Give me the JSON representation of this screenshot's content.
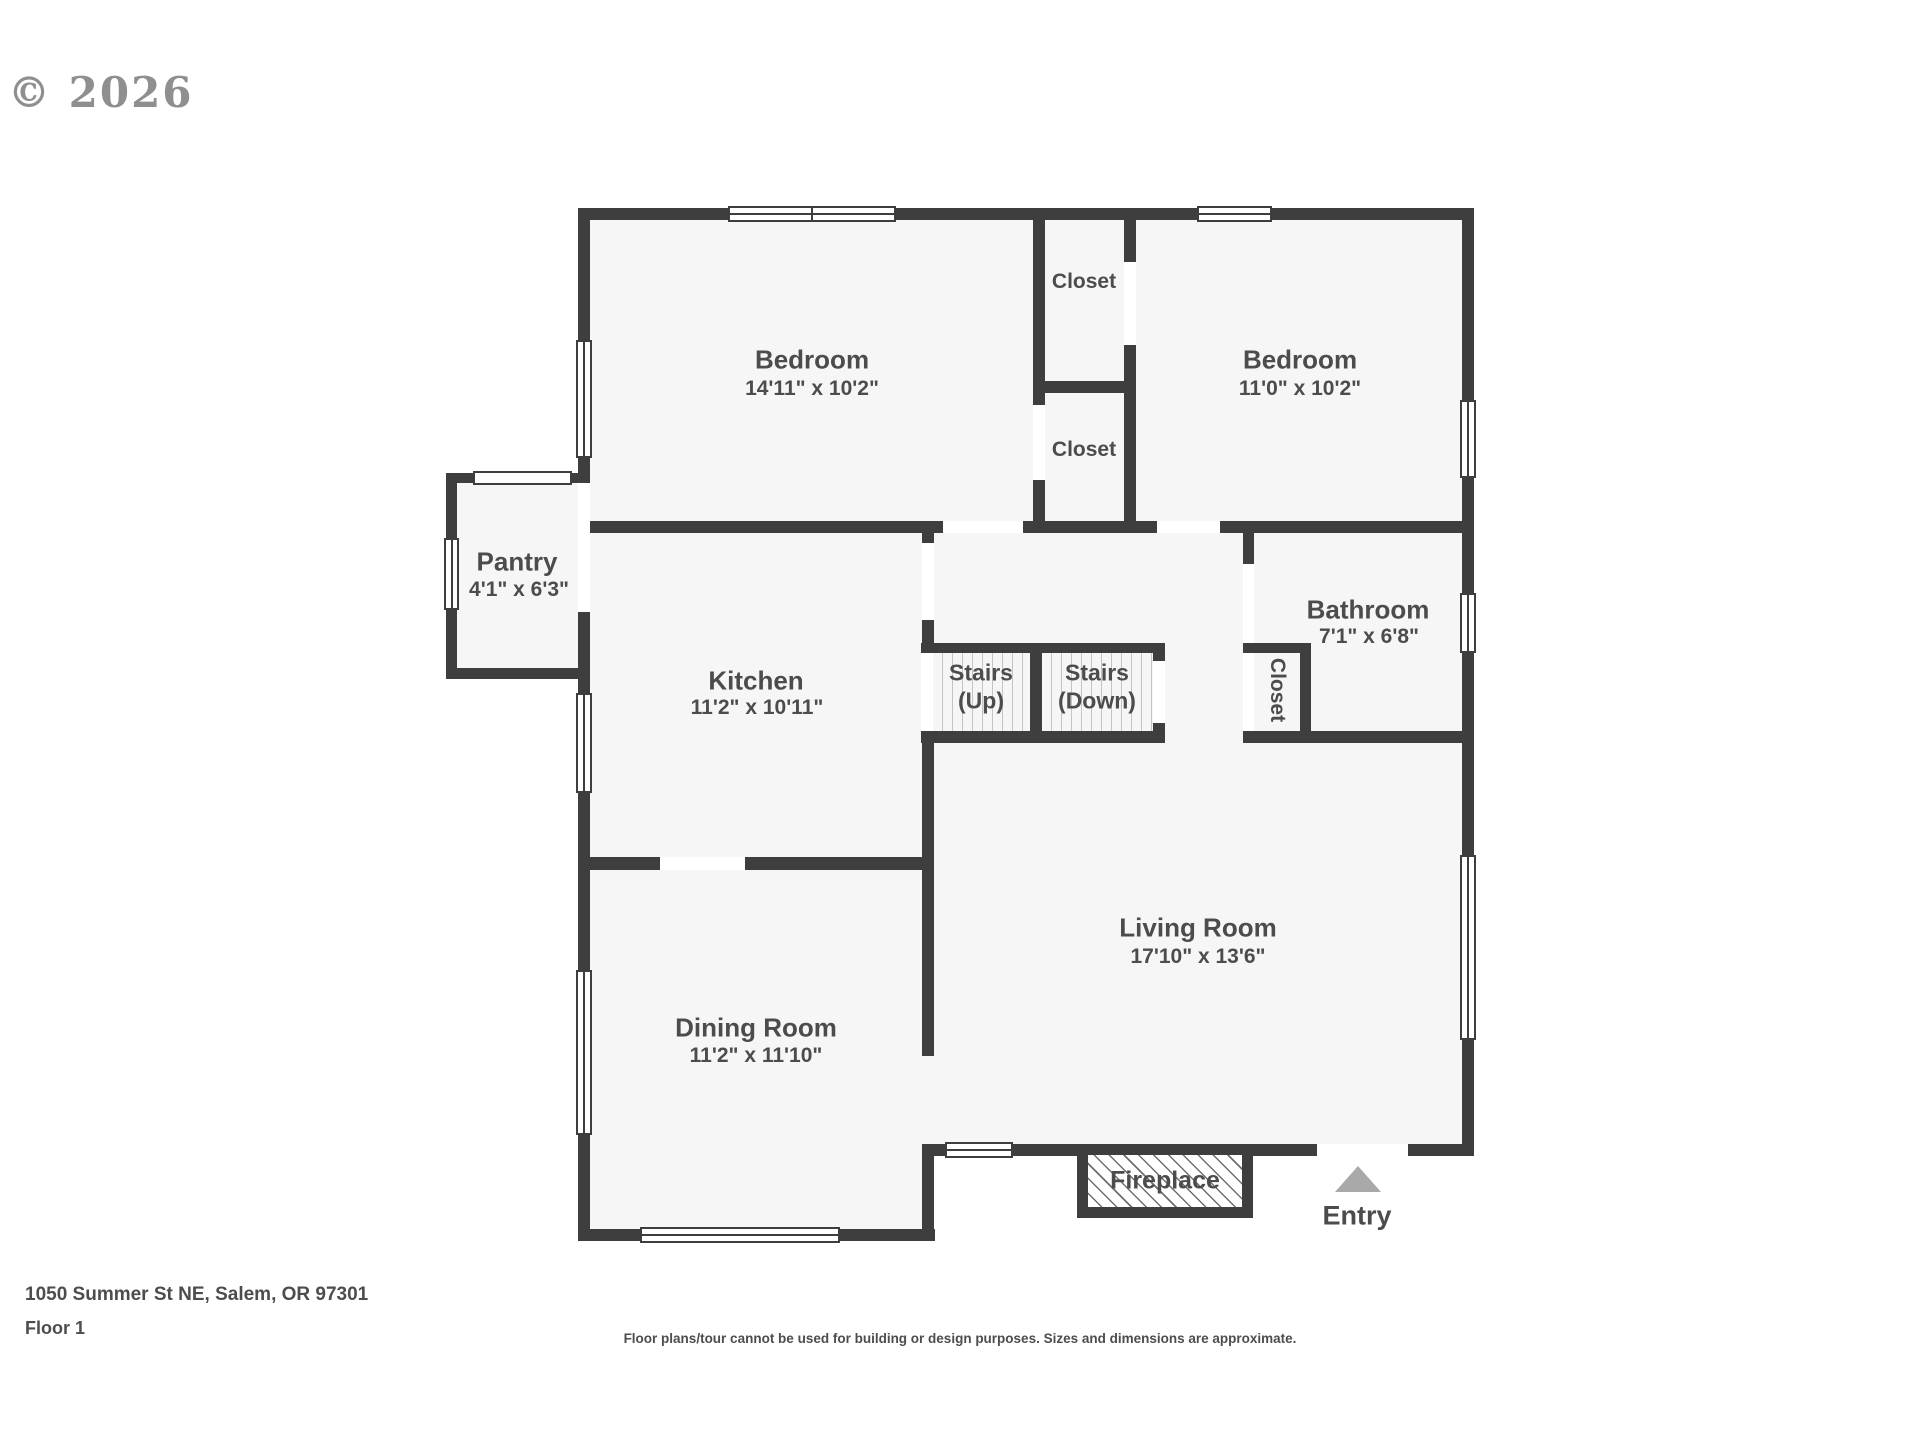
{
  "watermark": "© 2026",
  "rooms": {
    "bedroom1": {
      "name": "Bedroom",
      "dims": "14'11\" x 10'2\""
    },
    "bedroom2": {
      "name": "Bedroom",
      "dims": "11'0\" x 10'2\""
    },
    "closet_top": {
      "name": "Closet"
    },
    "closet_bottom": {
      "name": "Closet"
    },
    "pantry": {
      "name": "Pantry",
      "dims": "4'1\" x 6'3\""
    },
    "kitchen": {
      "name": "Kitchen",
      "dims": "11'2\" x 10'11\""
    },
    "bathroom": {
      "name": "Bathroom",
      "dims": "7'1\" x 6'8\""
    },
    "bath_closet": {
      "name": "Closet"
    },
    "living": {
      "name": "Living Room",
      "dims": "17'10\" x 13'6\""
    },
    "dining": {
      "name": "Dining Room",
      "dims": "11'2\" x 11'10\""
    },
    "stairs_up": {
      "line1": "Stairs",
      "line2": "(Up)"
    },
    "stairs_down": {
      "line1": "Stairs",
      "line2": "(Down)"
    }
  },
  "features": {
    "fireplace": "Fireplace",
    "entry": "Entry"
  },
  "footer": {
    "address": "1050 Summer St NE, Salem, OR 97301",
    "floor": "Floor 1",
    "disclaimer": "Floor plans/tour cannot be used for building or design purposes. Sizes and dimensions are approximate."
  },
  "colors": {
    "wall": "#3e3e3e",
    "floor": "#f6f6f6",
    "text": "#4c4c4c",
    "entry_arrow": "#a9a9a9"
  }
}
